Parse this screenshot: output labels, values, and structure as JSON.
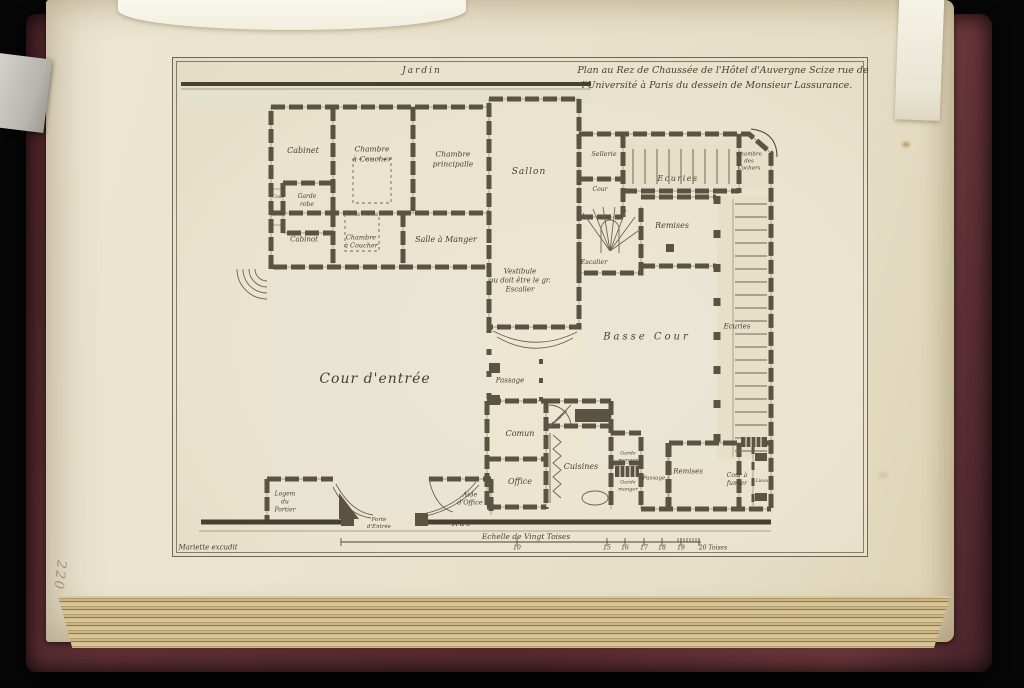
{
  "page": {
    "page_number": "220"
  },
  "plate": {
    "title_line1": "Plan au Rez de Chaussée de l'Hôtel d'Auvergne Scize rue de",
    "title_line2": "l'Université à Paris du dessein de Monsieur Lassurance.",
    "garden_label": "Jardin",
    "street_label": "Rue",
    "printer_credit": "Mariette excudit",
    "scale": {
      "label": "Echelle de Vingt Toises",
      "ticks": [
        {
          "label": "10",
          "x": 516
        },
        {
          "label": "15",
          "x": 606
        },
        {
          "label": "16",
          "x": 624
        },
        {
          "label": "17",
          "x": 643
        },
        {
          "label": "18",
          "x": 661
        },
        {
          "label": "19",
          "x": 680
        },
        {
          "label": "20 Toises",
          "x": 712
        }
      ]
    },
    "labels": [
      {
        "text": "Jardin",
        "x": 421,
        "y": 71,
        "s": 9,
        "ls": 2
      },
      {
        "text": "Plan au Rez de Chaussée de l'Hôtel d'Auvergne Scize rue de",
        "x": 722,
        "y": 70,
        "s": 9.5
      },
      {
        "text": "l'Université à Paris du dessein de Monsieur Lassurance.",
        "x": 716,
        "y": 85,
        "s": 9.5
      },
      {
        "text": "Cabinet",
        "x": 302,
        "y": 150,
        "s": 8
      },
      {
        "text": "Chambre\nà Coucher",
        "x": 371,
        "y": 153,
        "s": 7.5
      },
      {
        "text": "Chambre\nprincipalle",
        "x": 452,
        "y": 158,
        "s": 7.5
      },
      {
        "text": "Sallon",
        "x": 528,
        "y": 172,
        "s": 9,
        "ls": 1
      },
      {
        "text": "Garde\nrobe",
        "x": 306,
        "y": 200,
        "s": 6
      },
      {
        "text": "Cour",
        "x": 277,
        "y": 197,
        "s": 4.5
      },
      {
        "text": "Cabinot",
        "x": 303,
        "y": 239,
        "s": 7
      },
      {
        "text": "Chambre\nà Coucher",
        "x": 360,
        "y": 241,
        "s": 6.5
      },
      {
        "text": "Salle à Manger",
        "x": 445,
        "y": 239,
        "s": 8
      },
      {
        "text": "Vestibule\nou doit être le gr.\nEscalier",
        "x": 519,
        "y": 280,
        "s": 7
      },
      {
        "text": "Sellerie",
        "x": 603,
        "y": 153,
        "s": 6.5
      },
      {
        "text": "Ecuries",
        "x": 677,
        "y": 178,
        "s": 8,
        "ls": 1.5
      },
      {
        "text": "Chambre\ndes\nCochers",
        "x": 748,
        "y": 161,
        "s": 5.5
      },
      {
        "text": "Cour",
        "x": 599,
        "y": 189,
        "s": 6
      },
      {
        "text": "Remises",
        "x": 671,
        "y": 225,
        "s": 8
      },
      {
        "text": "Escalier",
        "x": 593,
        "y": 261,
        "s": 6.5
      },
      {
        "text": "Basse Cour",
        "x": 646,
        "y": 336,
        "s": 10,
        "ls": 3
      },
      {
        "text": "Ecuries",
        "x": 736,
        "y": 326,
        "s": 7
      },
      {
        "text": "Cour d'entrée",
        "x": 374,
        "y": 378,
        "s": 14,
        "ls": 1
      },
      {
        "text": "Passage",
        "x": 509,
        "y": 380,
        "s": 7
      },
      {
        "text": "Comun",
        "x": 519,
        "y": 433,
        "s": 8
      },
      {
        "text": "Office",
        "x": 519,
        "y": 481,
        "s": 8
      },
      {
        "text": "Cuisines",
        "x": 580,
        "y": 466,
        "s": 8
      },
      {
        "text": "Garde\nmanger",
        "x": 627,
        "y": 456,
        "s": 5
      },
      {
        "text": "Garde\nmanger",
        "x": 627,
        "y": 485,
        "s": 5
      },
      {
        "text": "Passage",
        "x": 653,
        "y": 478,
        "s": 5.5
      },
      {
        "text": "Remises",
        "x": 687,
        "y": 471,
        "s": 7
      },
      {
        "text": "Cour à\nfumier",
        "x": 736,
        "y": 479,
        "s": 6
      },
      {
        "text": "Lieux",
        "x": 761,
        "y": 481,
        "s": 4.5
      },
      {
        "text": "Logem\ndu\nPortier",
        "x": 284,
        "y": 501,
        "s": 6
      },
      {
        "text": "Aide\nd'Office",
        "x": 469,
        "y": 498,
        "s": 6.5
      },
      {
        "text": "Porte\nd'Entrée",
        "x": 378,
        "y": 523,
        "s": 5.5
      },
      {
        "text": "Rue",
        "x": 461,
        "y": 523,
        "s": 8,
        "ls": 1.5
      },
      {
        "text": "Echelle de Vingt Toises",
        "x": 525,
        "y": 536,
        "s": 7.5
      },
      {
        "text": "Mariette excudit",
        "x": 207,
        "y": 547,
        "s": 7
      }
    ]
  },
  "colors": {
    "cover_maroon": "#56292e",
    "paper_cream": "#e9e2cc",
    "ink": "#46412f",
    "wall": "#5a5342"
  }
}
